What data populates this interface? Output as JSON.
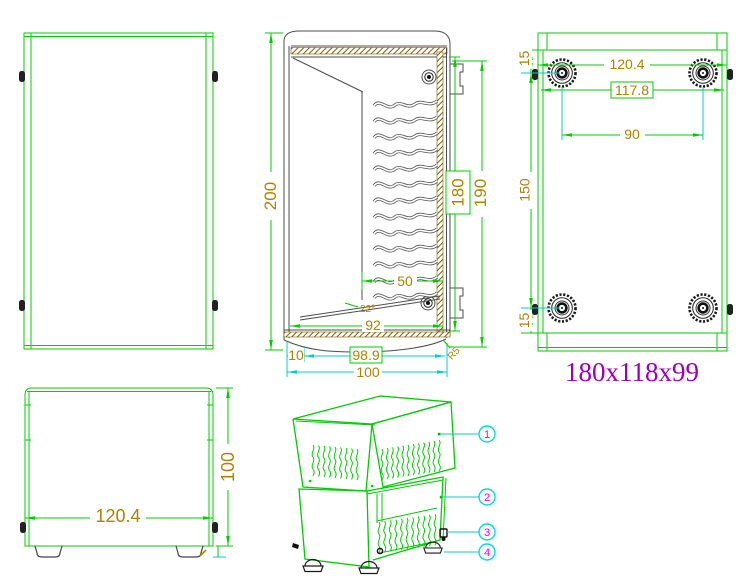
{
  "colors": {
    "view_green": "#00cc00",
    "dim_cyan": "#00cccc",
    "dim_text": "#b08000",
    "hatch_olive": "#7a6000",
    "section_gray": "#4d4d4d",
    "part_dark": "#1a1a1a",
    "balloon_magenta": "#ee00ee",
    "size_label_purple": "#9900bb"
  },
  "section_view": {
    "dim_200": "200",
    "dim_190": "190",
    "dim_180": "180",
    "dim_50": "50",
    "angle_22": "22°",
    "dim_92": "92",
    "dim_10": "10",
    "dim_98_9": "98.9",
    "dim_100": "100",
    "radius_r5": "R5"
  },
  "bottom_view": {
    "dim_15_top": "15",
    "dim_120_4": "120.4",
    "dim_117_8": "117.8",
    "dim_90": "90",
    "dim_150": "150",
    "dim_15_bottom": "15"
  },
  "front_view": {
    "dim_120_4": "120.4",
    "dim_100": "100"
  },
  "size_label": "180x118x99",
  "balloons": [
    {
      "label": "1"
    },
    {
      "label": "2"
    },
    {
      "label": "3"
    },
    {
      "label": "4"
    }
  ]
}
